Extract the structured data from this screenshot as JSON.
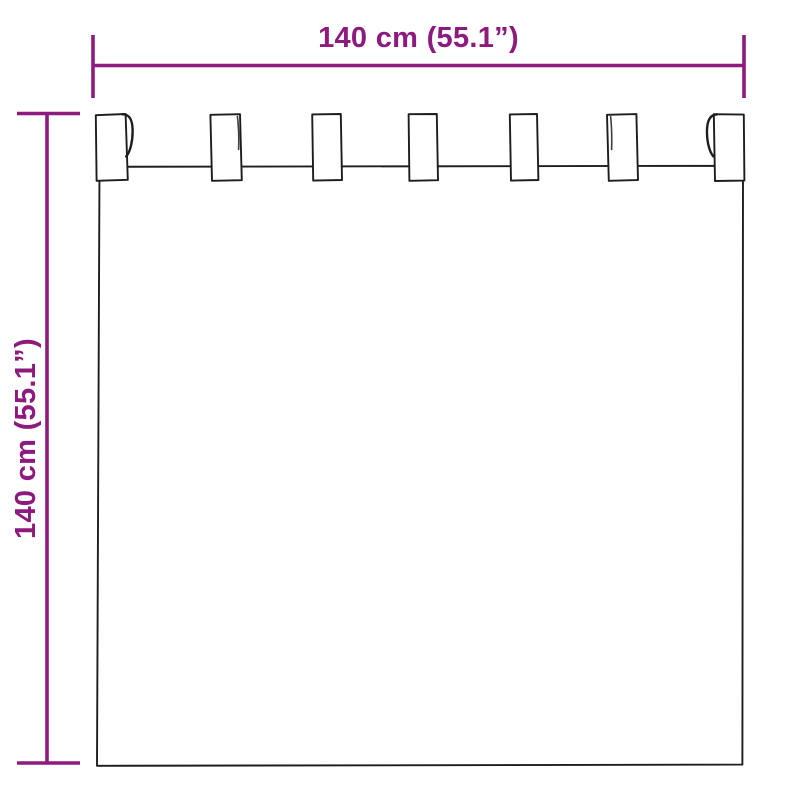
{
  "diagram": {
    "width_dimension": {
      "label": "140 cm (55.1”)"
    },
    "height_dimension": {
      "label": "140 cm (55.1”)"
    },
    "curtain": {
      "tab_count": 7
    },
    "colors": {
      "dimension_accent": "#8d1a7e",
      "outline": "#1d1d1b",
      "background": "#ffffff"
    }
  }
}
